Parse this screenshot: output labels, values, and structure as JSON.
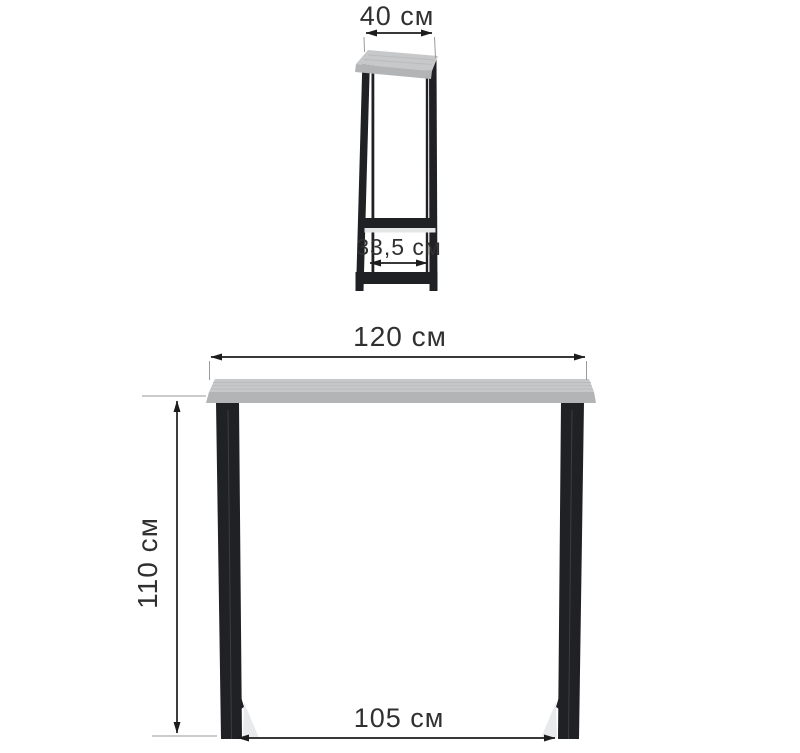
{
  "dimensions": {
    "depth": "40 см",
    "leg_inner_depth": "33,5 см",
    "width": "120 см",
    "height": "110 см",
    "leg_inner_width": "105 см"
  },
  "colors": {
    "background": "#ffffff",
    "dimension_line": "#1c1c1c",
    "dimension_text": "#303030",
    "extension_line": "#9a9a9a",
    "tabletop_top": "#c6c8ca",
    "tabletop_edge": "#b2b4b6",
    "tabletop_grain": "#b9bbbd",
    "leg": "#202124"
  }
}
